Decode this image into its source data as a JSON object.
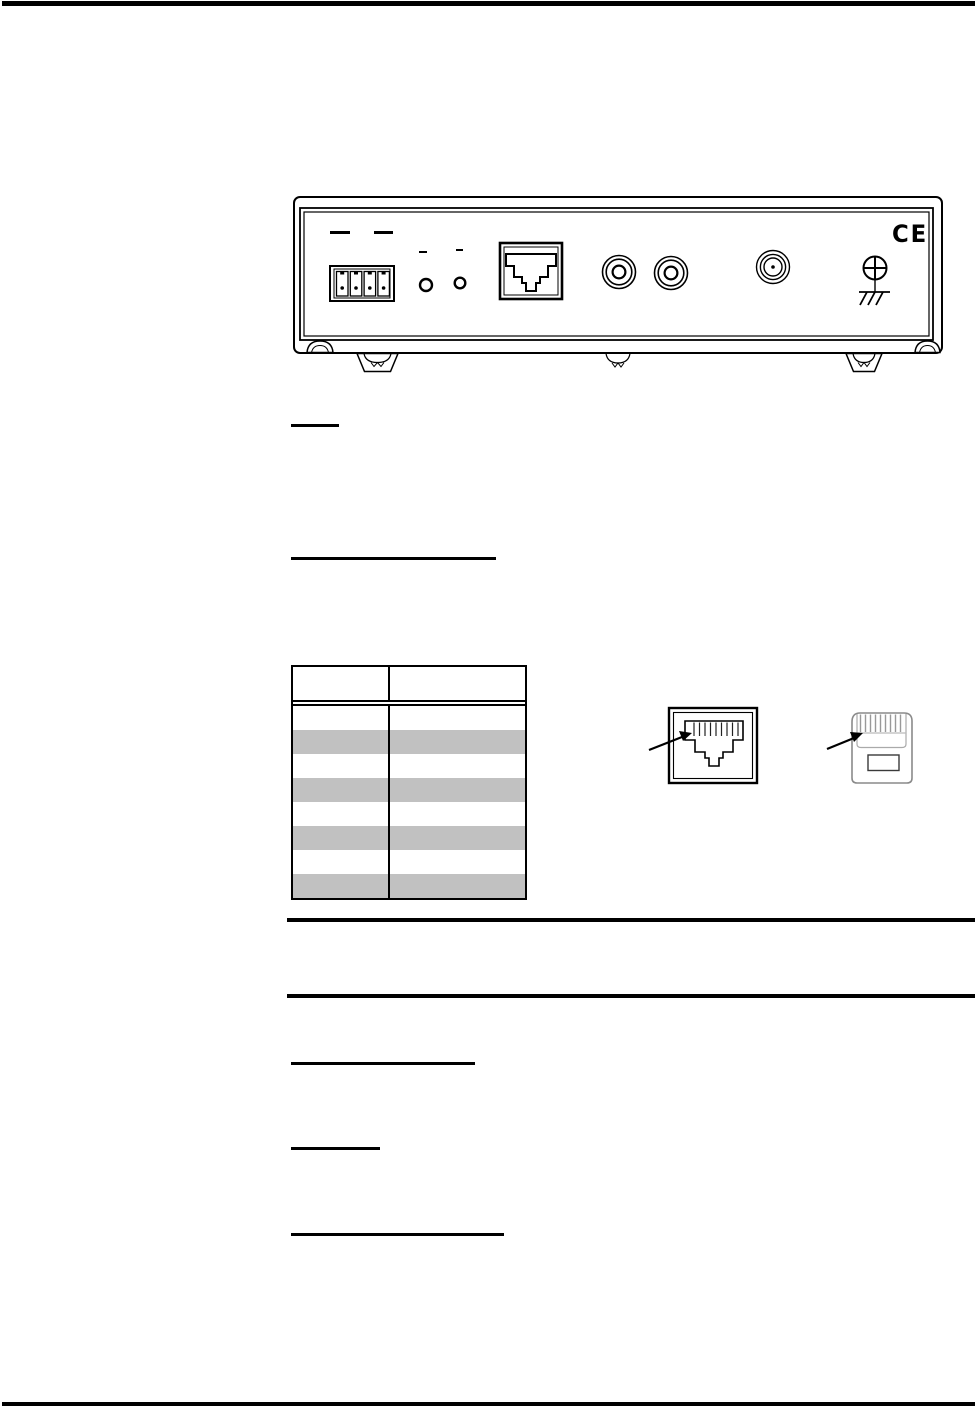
{
  "page": {
    "background": "#ffffff",
    "rule_color": "#000000"
  },
  "figures": {
    "rear_panel": {
      "description": "device-rear-panel-line-drawing",
      "ce_mark": "CE"
    },
    "rj45_jack": {
      "description": "rj45-jack-front-view-with-pin1-arrow"
    },
    "rj45_plug": {
      "description": "rj45-plug-view-with-pin1-arrow"
    }
  },
  "pinout_table": {
    "column_headers": [
      "",
      ""
    ],
    "rows": [
      [
        "",
        ""
      ],
      [
        "",
        ""
      ],
      [
        "",
        ""
      ],
      [
        "",
        ""
      ],
      [
        "",
        ""
      ],
      [
        "",
        ""
      ],
      [
        "",
        ""
      ],
      [
        "",
        ""
      ]
    ],
    "zebra_color": "#c1c1c1",
    "border_color": "#000000"
  }
}
